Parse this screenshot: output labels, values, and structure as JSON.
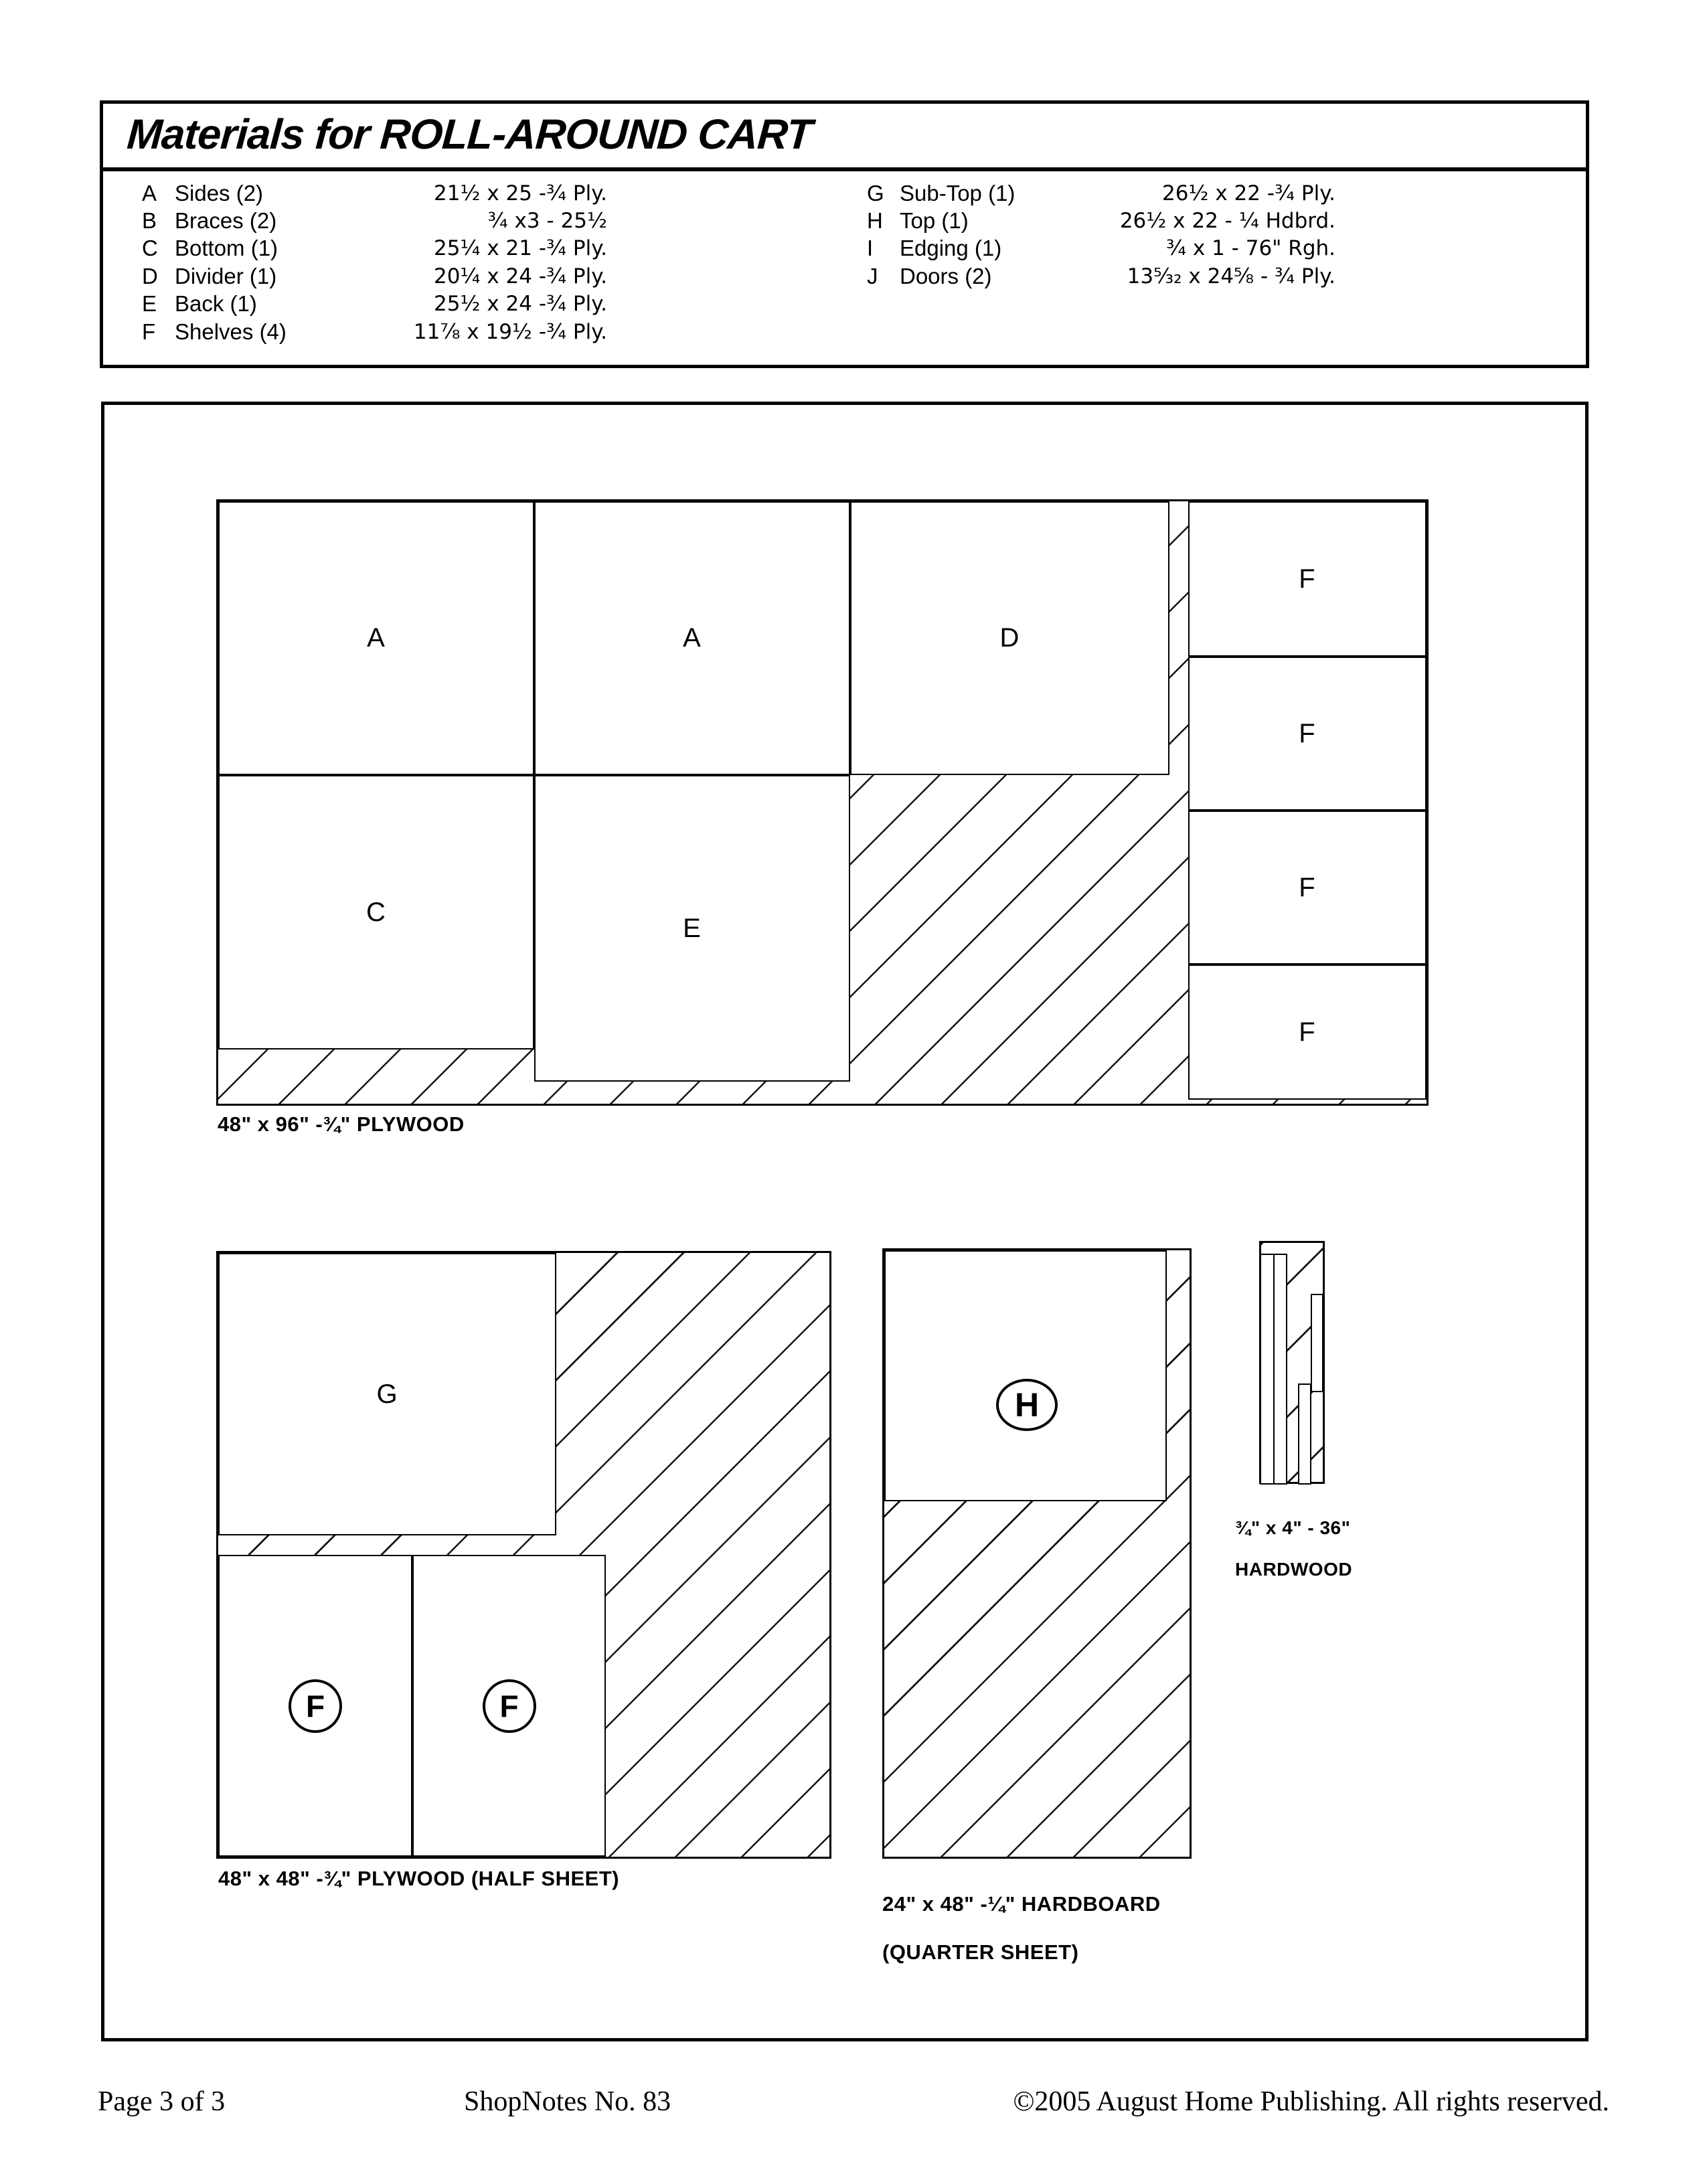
{
  "title": "Materials for ROLL-AROUND CART",
  "materials": {
    "col1": [
      {
        "letter": "A",
        "name": "Sides (2)",
        "dim": "21½ x 25 -¾ Ply."
      },
      {
        "letter": "B",
        "name": "Braces (2)",
        "dim": "¾ x3 - 25½"
      },
      {
        "letter": "C",
        "name": "Bottom (1)",
        "dim": "25¼ x 21 -¾ Ply."
      },
      {
        "letter": "D",
        "name": "Divider (1)",
        "dim": "20¼ x 24 -¾ Ply."
      },
      {
        "letter": "E",
        "name": "Back (1)",
        "dim": "25½ x 24 -¾ Ply."
      },
      {
        "letter": "F",
        "name": "Shelves (4)",
        "dim": "11⅞ x 19½ -¾ Ply."
      }
    ],
    "col2": [
      {
        "letter": "G",
        "name": "Sub-Top (1)",
        "dim": "26½ x 22 -¾ Ply."
      },
      {
        "letter": "H",
        "name": "Top (1)",
        "dim": "26½ x 22 - ¼ Hdbrd."
      },
      {
        "letter": "I",
        "name": "Edging (1)",
        "dim": "¾ x 1 - 76\" Rgh."
      },
      {
        "letter": "J",
        "name": "Doors (2)",
        "dim": "13⁵⁄₃₂ x 24⅝ - ¾ Ply."
      }
    ]
  },
  "sheet1": {
    "caption": "48\" x 96\" -¾\" PLYWOOD",
    "pieces": [
      "A",
      "A",
      "D",
      "C",
      "E",
      "F",
      "F",
      "F",
      "F"
    ]
  },
  "sheet2": {
    "caption": "48\" x 48\" -¾\" PLYWOOD (HALF SHEET)",
    "pieces": [
      "G",
      "F",
      "F"
    ]
  },
  "sheet3": {
    "caption_line1": "24\" x 48\" -¼\" HARDBOARD",
    "caption_line2": "(QUARTER SHEET)",
    "pieces": [
      "H"
    ]
  },
  "sheet4": {
    "caption_line1": "¾\" x 4\" - 36\"",
    "caption_line2": "HARDWOOD"
  },
  "footer": {
    "page": "Page 3 of 3",
    "publication": "ShopNotes No. 83",
    "copyright": "©2005 August Home Publishing. All rights reserved."
  }
}
